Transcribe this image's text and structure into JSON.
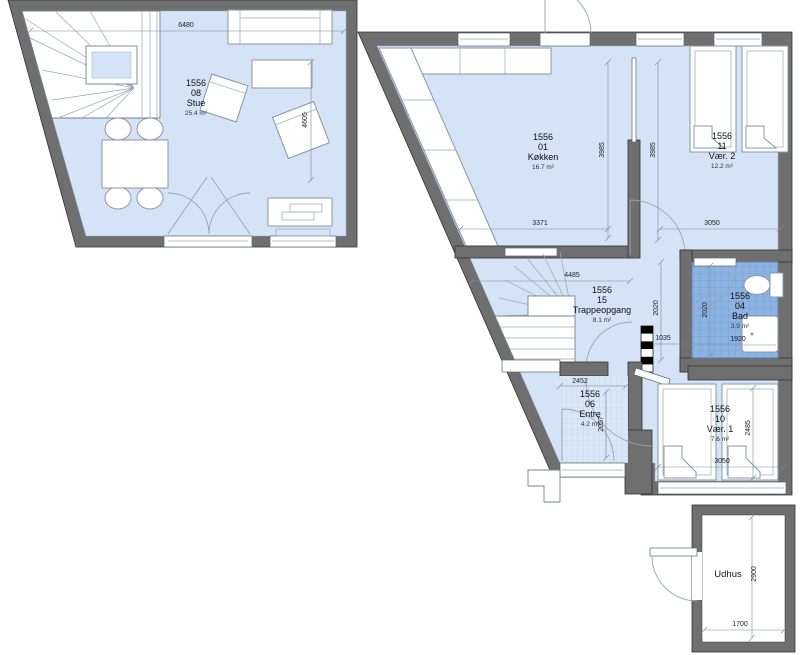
{
  "unit_label": "1556",
  "rooms": {
    "stue": {
      "id": "1556",
      "number": "08",
      "name": "Stue",
      "area": "25.4 m²"
    },
    "kokken": {
      "id": "1556",
      "number": "01",
      "name": "Køkken",
      "area": "16.7 m²"
    },
    "vaer2": {
      "id": "1556",
      "number": "11",
      "name": "Vær. 2",
      "area": "12.2 m²"
    },
    "trappeopgang": {
      "id": "1556",
      "number": "15",
      "name": "Trappeopgang",
      "area": "8.1 m²"
    },
    "bad": {
      "id": "1556",
      "number": "04",
      "name": "Bad",
      "area": "3.9 m²"
    },
    "entre": {
      "id": "1556",
      "number": "06",
      "name": "Entre",
      "area": "4.2 m²"
    },
    "vaer1": {
      "id": "1556",
      "number": "10",
      "name": "Vær. 1",
      "area": "7.6 m²"
    },
    "udhus": {
      "name": "Udhus"
    }
  },
  "dims": {
    "stue_w": "6480",
    "stue_d": "4605",
    "kokken_h": "3985",
    "hall_h": "3985",
    "kokken_w": "3371",
    "vaer2_w": "3050",
    "trappe_w": "4485",
    "hall_d": "2020",
    "hall_w": "1035",
    "bad_d": "2020",
    "bad_w": "1920",
    "entre_w": "2452",
    "entre_d": "2057",
    "vaer1_d": "2485",
    "vaer1_w": "3050",
    "udhus_d": "2900",
    "udhus_w": "1700"
  },
  "colors": {
    "wall": "#6f6f6f",
    "floor": "#d4e3f5",
    "bath_tile": "#8db3e2",
    "entre_tile": "#d9e7f6"
  }
}
